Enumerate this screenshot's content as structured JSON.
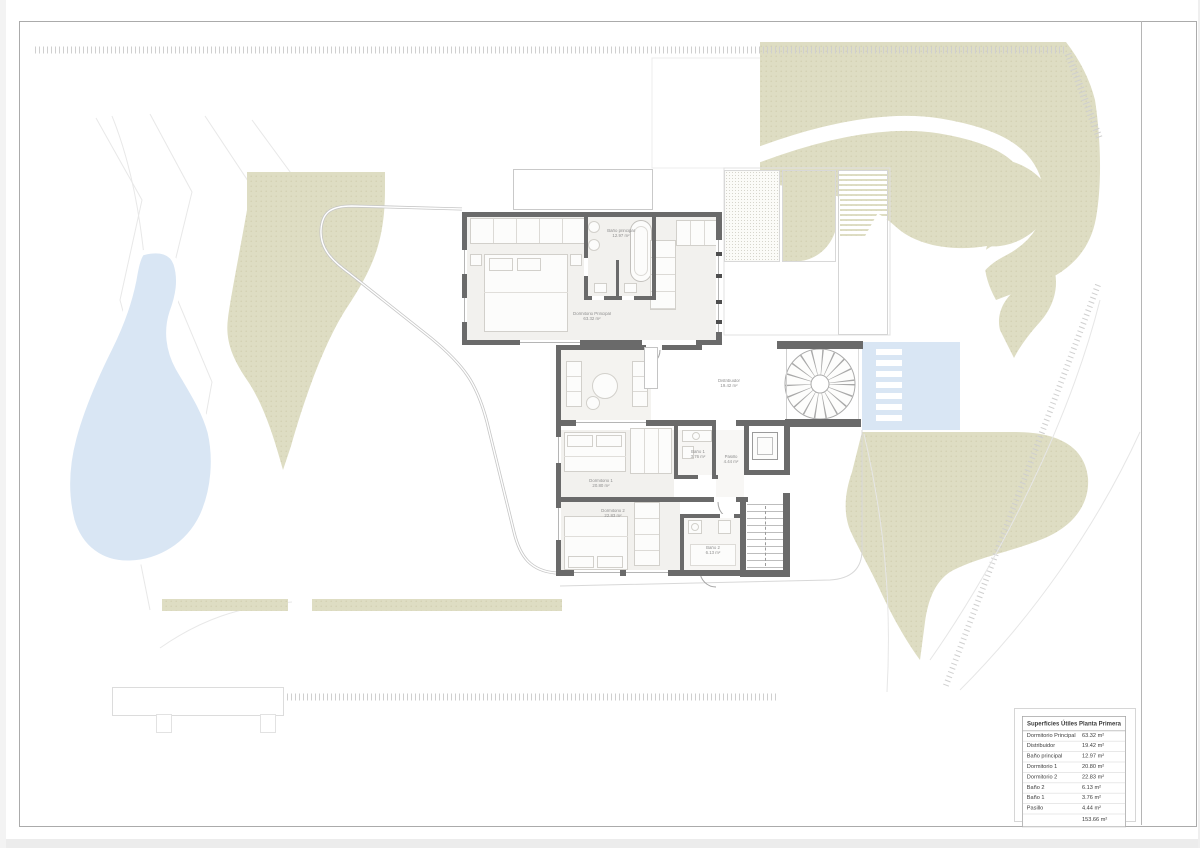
{
  "title_block": {
    "title": "Superficies Útiles Planta Primera",
    "rows": [
      {
        "label": "Dormitorio Principal",
        "value": "63.32 m²"
      },
      {
        "label": "Distribuidor",
        "value": "19.42 m²"
      },
      {
        "label": "Baño principal",
        "value": "12.97 m²"
      },
      {
        "label": "Dormitorio 1",
        "value": "20.80 m²"
      },
      {
        "label": "Dormitorio 2",
        "value": "22.83 m²"
      },
      {
        "label": "Baño 2",
        "value": "6.13 m²"
      },
      {
        "label": "Baño 1",
        "value": "3.76 m²"
      },
      {
        "label": "Pasillo",
        "value": "4.44 m²"
      }
    ],
    "total_label": "",
    "total": "153.66 m²"
  },
  "plan": {
    "rooms": [
      {
        "name": "Baño principal",
        "area": "12.97 m²"
      },
      {
        "name": "Dormitorio Principal",
        "area": "63.32 m²"
      },
      {
        "name": "Distribuidor",
        "area": "19.42 m²"
      },
      {
        "name": "Dormitorio 1",
        "area": "20.80 m²"
      },
      {
        "name": "Baño 1",
        "area": "3.76 m²"
      },
      {
        "name": "Pasillo",
        "area": "4.44 m²"
      },
      {
        "name": "Dormitorio 2",
        "area": "22.83 m²"
      },
      {
        "name": "Baño 2",
        "area": "6.13 m²"
      }
    ]
  },
  "colors": {
    "wall": "#6a6a6a",
    "greenery": "#deddc3",
    "water": "#d9e6f4",
    "frame": "#ababab"
  }
}
